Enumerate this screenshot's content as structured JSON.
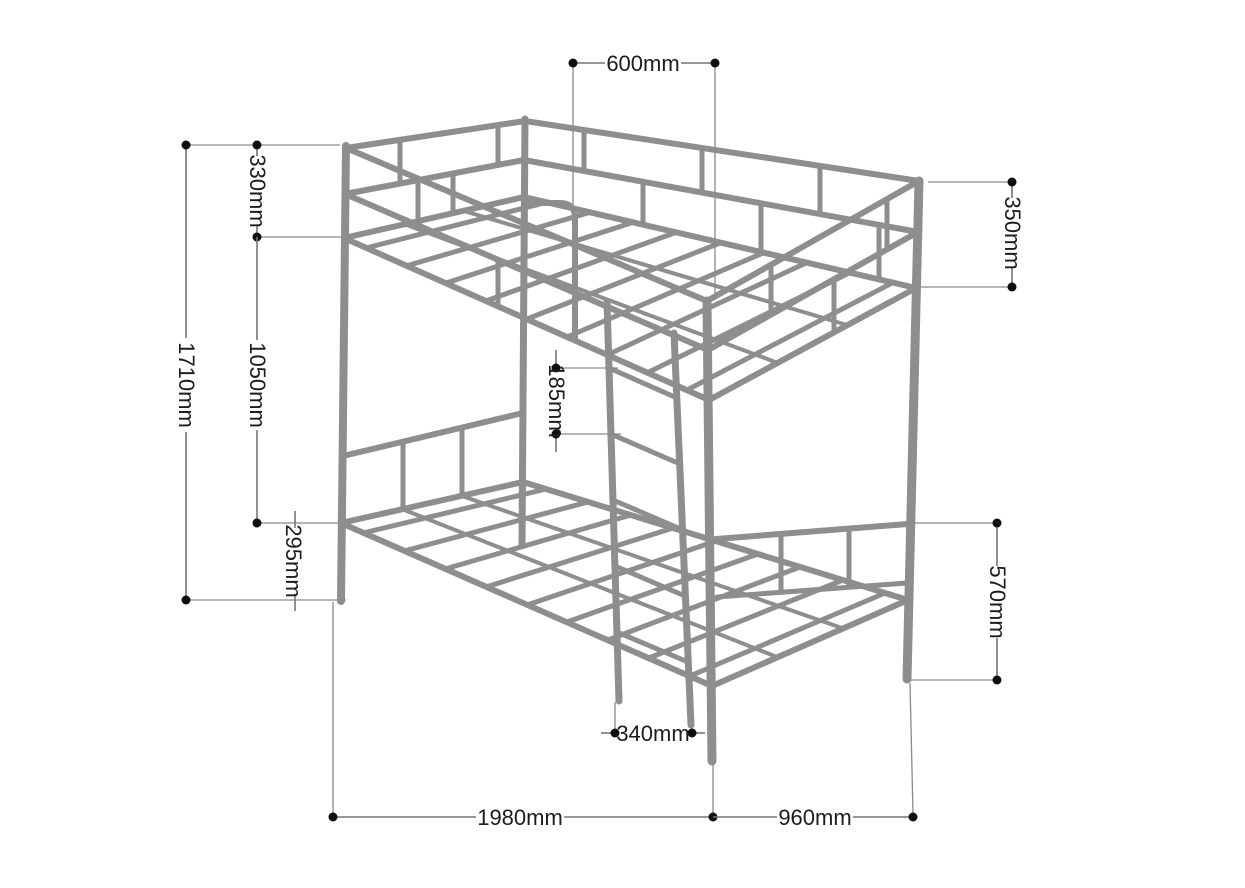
{
  "diagram": {
    "subject": "bunk-bed-frame-dimension-drawing",
    "unit": "mm"
  },
  "dimensions": [
    {
      "id": "ladder-section-top-width",
      "label": "600mm",
      "orientation": "horizontal"
    },
    {
      "id": "upper-guard-rail-height",
      "label": "330mm",
      "orientation": "vertical"
    },
    {
      "id": "total-height",
      "label": "1710mm",
      "orientation": "vertical"
    },
    {
      "id": "bunk-gap-height",
      "label": "1050mm",
      "orientation": "vertical"
    },
    {
      "id": "lower-frame-height",
      "label": "295mm",
      "orientation": "vertical"
    },
    {
      "id": "ladder-rung-spacing",
      "label": "185mm",
      "orientation": "vertical"
    },
    {
      "id": "rear-guard-rail-height",
      "label": "350mm",
      "orientation": "vertical"
    },
    {
      "id": "lower-footboard-height",
      "label": "570mm",
      "orientation": "vertical"
    },
    {
      "id": "ladder-width",
      "label": "340mm",
      "orientation": "horizontal"
    },
    {
      "id": "bed-length",
      "label": "1980mm",
      "orientation": "horizontal"
    },
    {
      "id": "bed-width",
      "label": "960mm",
      "orientation": "horizontal"
    }
  ],
  "colors": {
    "frame": "#8e8e8e",
    "dimension_line": "#757575",
    "extension_line": "#8a8a8a",
    "dot": "#0e0e0e",
    "text": "#1c1c1c",
    "background": "#ffffff"
  }
}
